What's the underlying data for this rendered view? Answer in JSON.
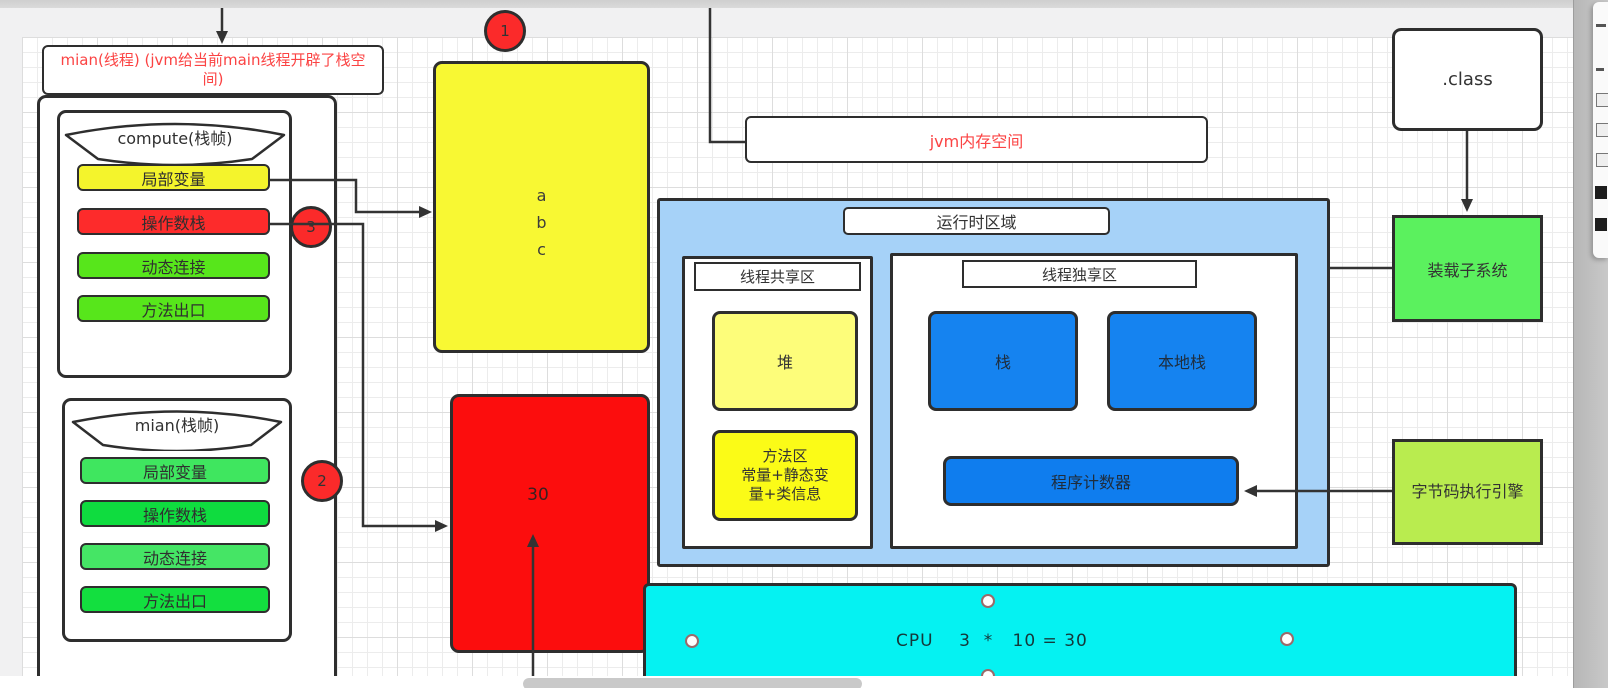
{
  "colors": {
    "canvas_bg": "#ffffff",
    "stroke": "#2e2e2e",
    "red_accent": "#fb4343",
    "row_yellow": "#f4f42c",
    "row_red": "#fd2b2b",
    "row_green_bright": "#57e61b",
    "row_green_1": "#3fe65f",
    "row_green_2": "#0fdc3f",
    "row_green_3": "#45e565",
    "row_green_4": "#13df3f",
    "big_yellow": "#f8f833",
    "big_red": "#fc0d0d",
    "blue_region": "#a6d2f8",
    "inner_blue": "#1583f0",
    "heap_yellow": "#fdfd7a",
    "method_yellow": "#fbfb17",
    "loader_green": "#5bf15e",
    "engine_green": "#b9ec4f",
    "cpu_cyan": "#05f2f2",
    "badge_red": "#fb2a2a"
  },
  "canvas": {
    "thread_box_label": "mian(线程)  (jvm给当前main线程开辟了栈空间)",
    "frames": {
      "compute": {
        "title": "compute(栈帧)",
        "rows": [
          "局部变量",
          "操作数栈",
          "动态连接",
          "方法出口"
        ]
      },
      "main": {
        "title": "mian(栈帧)",
        "rows": [
          "局部变量",
          "操作数栈",
          "动态连接",
          "方法出口"
        ]
      }
    },
    "badges": {
      "one": "1",
      "two": "2",
      "three": "3"
    },
    "local_vars_box": {
      "lines": [
        "a",
        "b",
        "c"
      ]
    },
    "result_box": {
      "value": "30"
    },
    "jvm_memory_label": "jvm内存空间",
    "runtime_area": {
      "label": "运行时区域",
      "shared": {
        "label": "线程共享区",
        "heap": "堆",
        "method_area_lines": [
          "方法区",
          "常量+静态变",
          "量+类信息"
        ]
      },
      "exclusive": {
        "label": "线程独享区",
        "stack": "栈",
        "native_stack": "本地栈",
        "pc_register": "程序计数器"
      }
    },
    "class_file": ".class",
    "class_loader": "装载子系统",
    "exec_engine": "字节码执行引擎",
    "cpu": {
      "text": "CPU    3  *   10 = 30"
    }
  }
}
